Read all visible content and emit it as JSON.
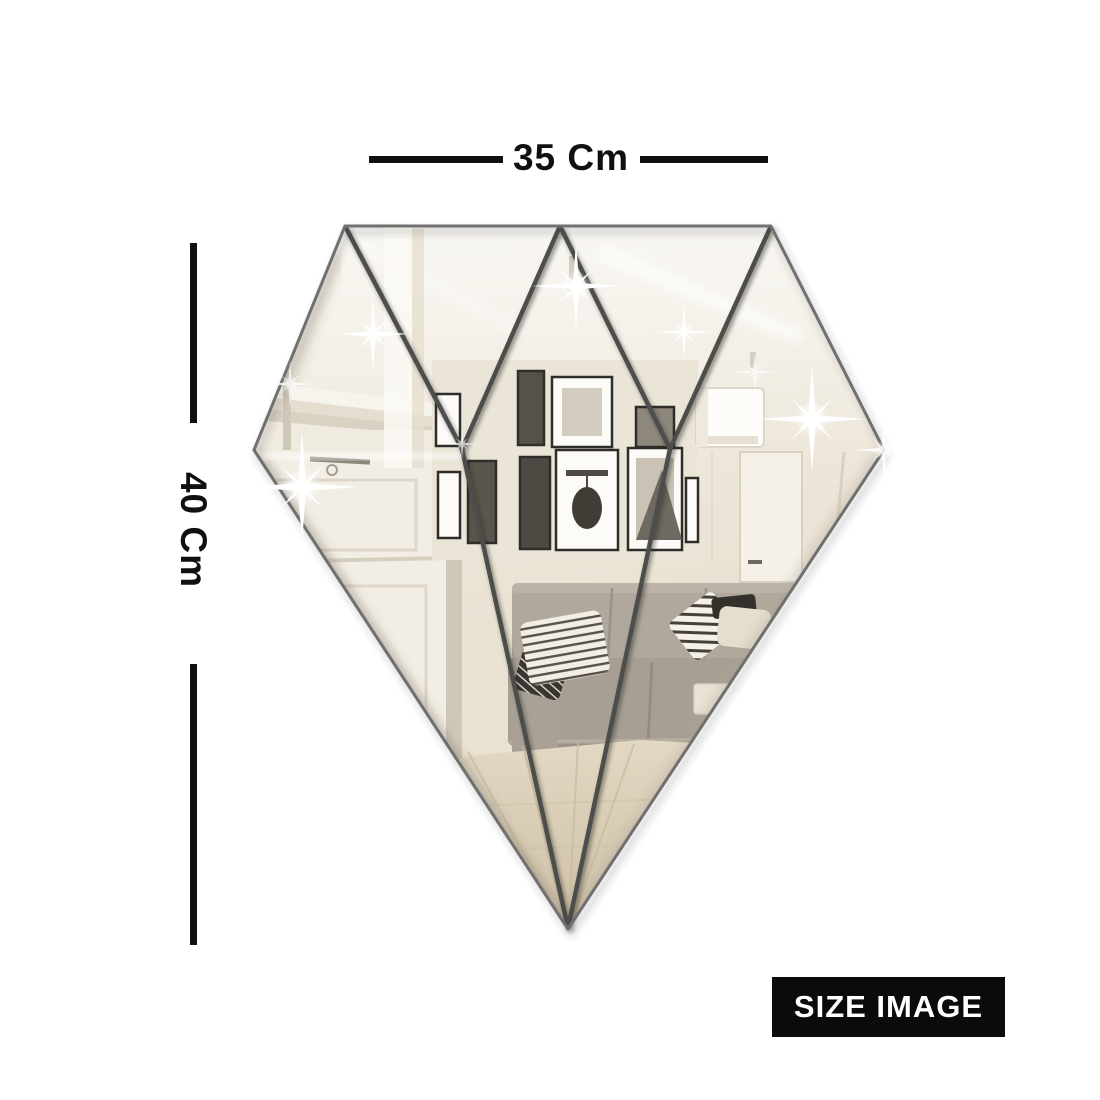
{
  "page": {
    "background": "#ffffff"
  },
  "dimensions": {
    "width": {
      "label": "35 Cm"
    },
    "height": {
      "label": "40 Cm"
    }
  },
  "badge": {
    "label": "SIZE IMAGE",
    "bg": "#0b0b0b",
    "text_color": "#ffffff"
  },
  "mirror": {
    "kind": "diamond-shaped faceted wall mirror reflecting a living room",
    "pieces_above_girdle": 5,
    "pieces_below_girdle": 3,
    "colors": {
      "outline": "#707070",
      "facet_line": "#4e4e4c",
      "girdle_line": "#3d3d3b",
      "glass_top": "#f3efe7",
      "glass_bottom": "#e8e0d1",
      "sofa": "#aba297",
      "floor": "#d9cdb6",
      "sparkle": "#ffffff"
    }
  }
}
